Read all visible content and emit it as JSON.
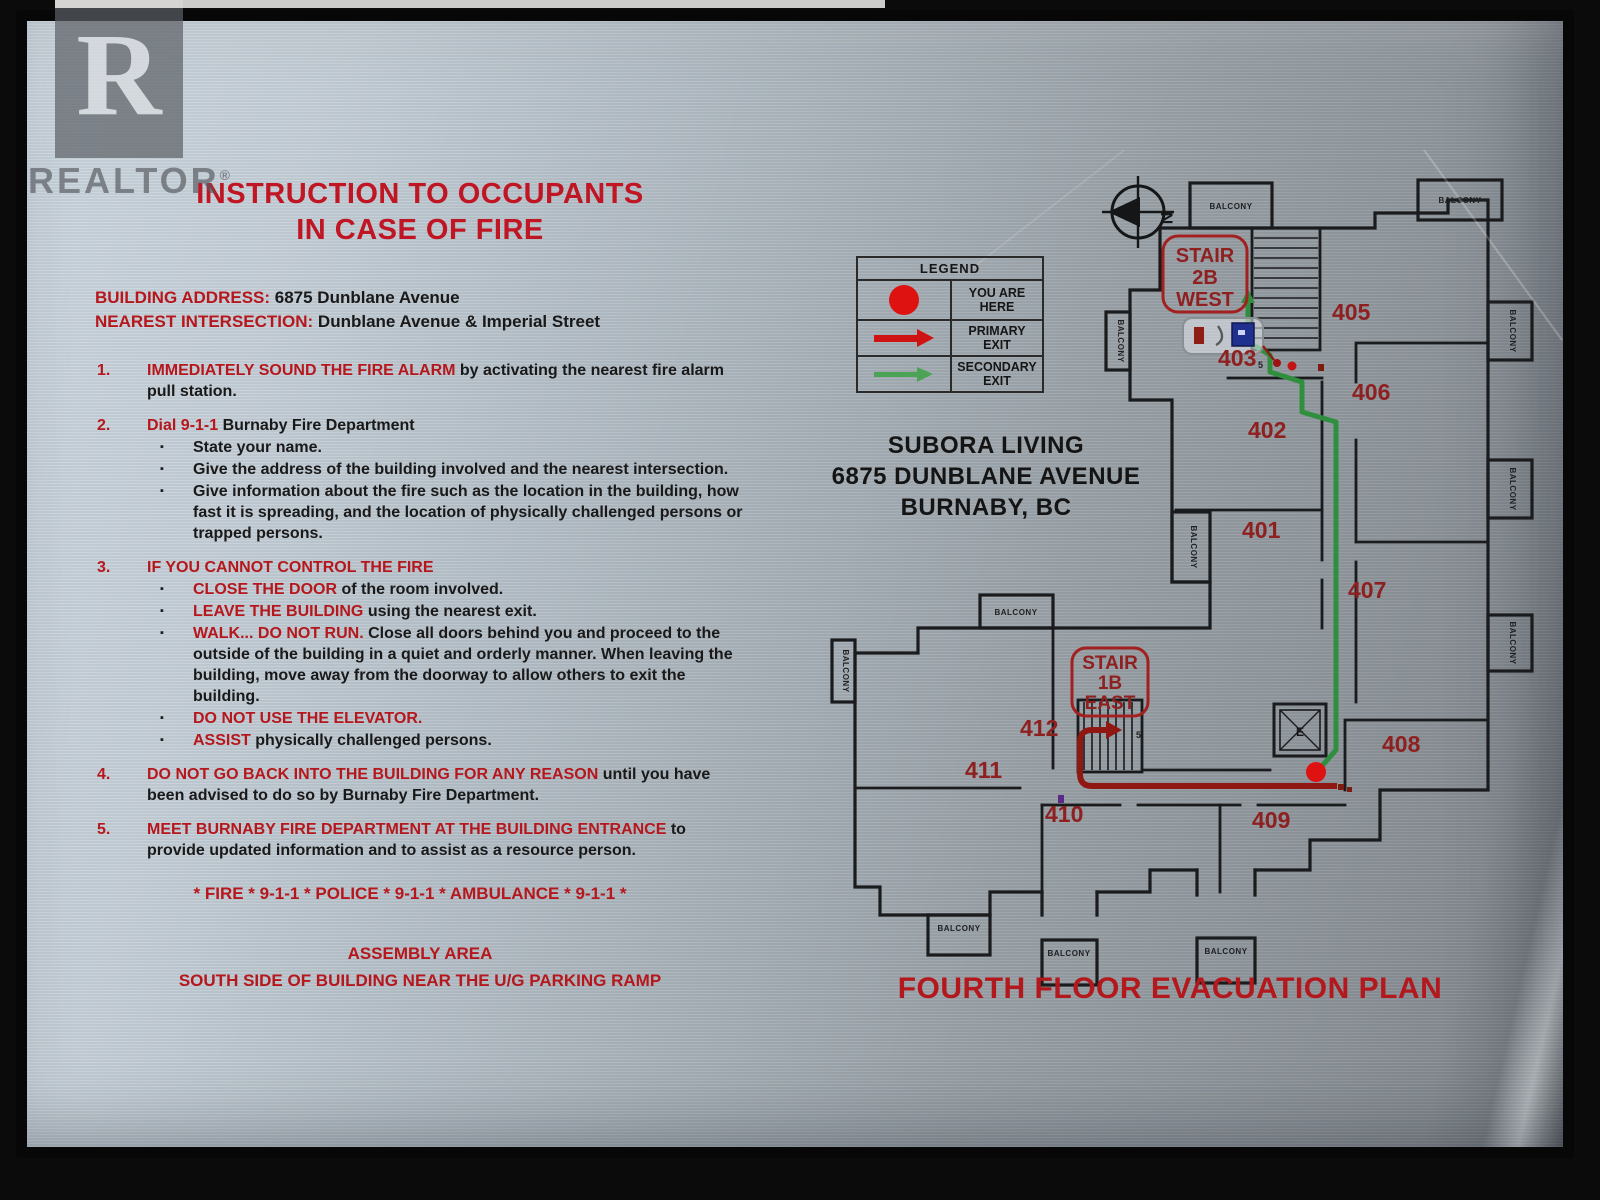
{
  "watermark": {
    "letter": "R",
    "name": "REALTOR",
    "reg": "®"
  },
  "colors": {
    "heading_red": "#c01523",
    "keyword_red": "#b5171c",
    "body_black": "#191919",
    "plan_label_red": "#8e2020",
    "primary_path": "#8f1812",
    "secondary_path": "#2f8f3f",
    "you_are_here": "#df1212",
    "wall": "#1a1b1d",
    "plaque_metal": "#b7c1c9"
  },
  "left": {
    "title_line1": "INSTRUCTION TO OCCUPANTS",
    "title_line2": "IN CASE OF FIRE",
    "address_label": "BUILDING ADDRESS:",
    "address_value": " 6875 Dunblane Avenue",
    "intersection_label": "NEAREST INTERSECTION:",
    "intersection_value": "  Dunblane Avenue & Imperial Street",
    "items": [
      {
        "num": "1.",
        "red": "IMMEDIATELY SOUND THE FIRE ALARM",
        "black": " by activating the nearest fire alarm pull station."
      },
      {
        "num": "2.",
        "red": "Dial 9-1-1",
        "black": " Burnaby Fire Department",
        "bullets": [
          {
            "red": "",
            "black": "State your name."
          },
          {
            "red": "",
            "black": "Give the address of the building involved and the nearest intersection."
          },
          {
            "red": "",
            "black": "Give information about the fire such as the location in the building, how fast it is spreading, and the location of physically challenged persons or trapped persons."
          }
        ]
      },
      {
        "num": "3.",
        "red": "IF YOU CANNOT CONTROL THE FIRE",
        "black": "",
        "bullets": [
          {
            "red": "CLOSE THE DOOR",
            "black": " of the room involved."
          },
          {
            "red": "LEAVE THE BUILDING",
            "black": " using the nearest exit."
          },
          {
            "red": "WALK... DO NOT RUN.",
            "black": "  Close all doors behind you and proceed to the outside of the building in a quiet and orderly manner. When leaving the building, move away from the doorway to allow others to exit the building."
          },
          {
            "red": "DO NOT USE THE ELEVATOR.",
            "black": ""
          },
          {
            "red": "ASSIST",
            "black": " physically challenged persons."
          }
        ]
      },
      {
        "num": "4.",
        "red": "DO NOT GO BACK INTO THE BUILDING FOR ANY REASON",
        "black": " until you have been advised to do so by Burnaby Fire Department."
      },
      {
        "num": "5.",
        "red": "MEET BURNABY FIRE DEPARTMENT AT THE BUILDING ENTRANCE",
        "black": " to provide updated information and to assist as a resource person."
      }
    ],
    "emergency_line": "* FIRE * 9-1-1 * POLICE * 9-1-1 * AMBULANCE * 9-1-1 *",
    "assembly_title": "ASSEMBLY AREA",
    "assembly_text": "SOUTH SIDE OF BUILDING NEAR THE U/G PARKING RAMP"
  },
  "legend": {
    "title": "LEGEND",
    "rows": [
      {
        "symbol": "you-are-here-dot",
        "line1": "YOU ARE",
        "line2": "HERE"
      },
      {
        "symbol": "primary-exit-arrow",
        "line1": "PRIMARY",
        "line2": "EXIT"
      },
      {
        "symbol": "secondary-exit-arrow",
        "line1": "SECONDARY",
        "line2": "EXIT"
      }
    ]
  },
  "building": {
    "name": "SUBORA LIVING",
    "address": "6875 DUNBLANE AVENUE",
    "city": "BURNABY, BC"
  },
  "plan": {
    "title": "FOURTH FLOOR EVACUATION PLAN",
    "north": "N",
    "elevator": "E",
    "balcony": "BALCONY",
    "stair_2b": {
      "l1": "STAIR",
      "l2": "2B",
      "l3": "WEST"
    },
    "stair_1b": {
      "l1": "STAIR",
      "l2": "1B",
      "l3": "EAST"
    },
    "rooms": {
      "r401": "401",
      "r402": "402",
      "r403": "403",
      "r405": "405",
      "r406": "406",
      "r407": "407",
      "r408": "408",
      "r409": "409",
      "r410": "410",
      "r411": "411",
      "r412": "412"
    }
  }
}
